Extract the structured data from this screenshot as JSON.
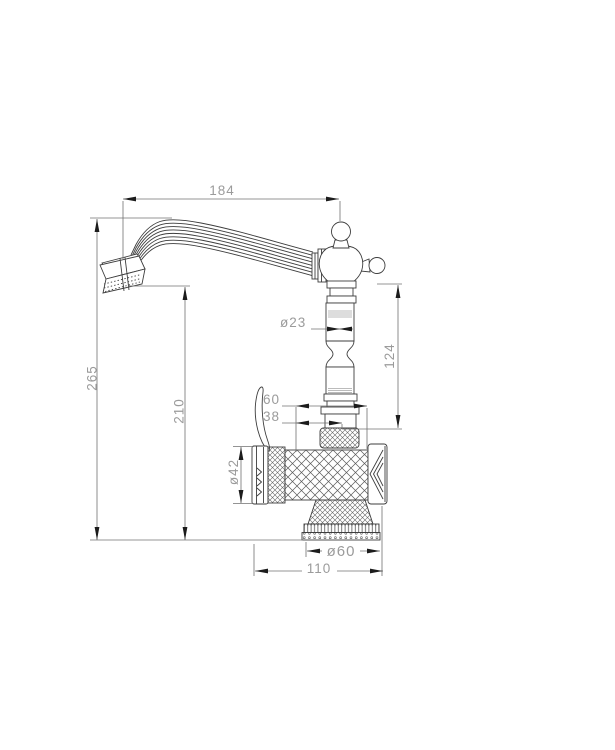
{
  "drawing": {
    "type": "technical-dimension-drawing",
    "subject": "classic single-hole basin faucet, side elevation",
    "background_color": "#ffffff",
    "line_color": "#3d3d3d",
    "dimension_text_color": "#9b9b9b",
    "dimensions": {
      "spout_reach": "184",
      "overall_height": "265",
      "spout_outlet_height": "210",
      "column_diameter": "ø23",
      "upper_column_height": "124",
      "offset_large": "60",
      "offset_small": "38",
      "body_diameter": "ø42",
      "base_diameter": "ø60",
      "body_length": "110"
    }
  }
}
